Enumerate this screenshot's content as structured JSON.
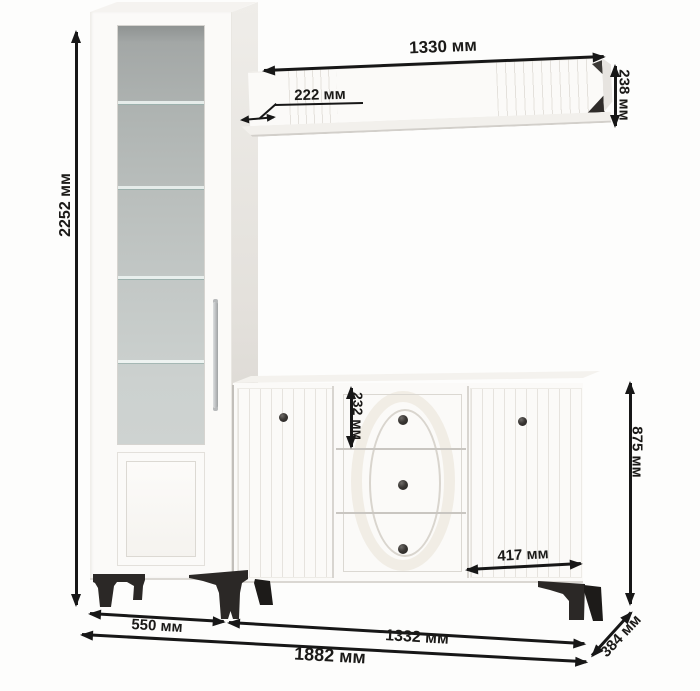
{
  "diagram": {
    "title": "furniture-wall-unit-dimensions",
    "units": "мм"
  },
  "dimensions": {
    "total_height": "2252 мм",
    "shelf_width": "1330 мм",
    "shelf_overhang": "222 мм",
    "shelf_height": "238 мм",
    "drawer_height": "232 мм",
    "door_width": "417 мм",
    "sideboard_height": "875 мм",
    "cabinet_width": "550 мм",
    "sideboard_width": "1332 мм",
    "total_width": "1882 мм",
    "depth": "384 мм"
  },
  "colors": {
    "arrow": "#171717",
    "label_text": "#1b1a18",
    "furniture_white": "#fbfaf8",
    "glass_top": "#999d9c",
    "glass_bottom": "#ced3d1",
    "leg_dark": "#2b2826",
    "background": "#fdfdfc"
  }
}
